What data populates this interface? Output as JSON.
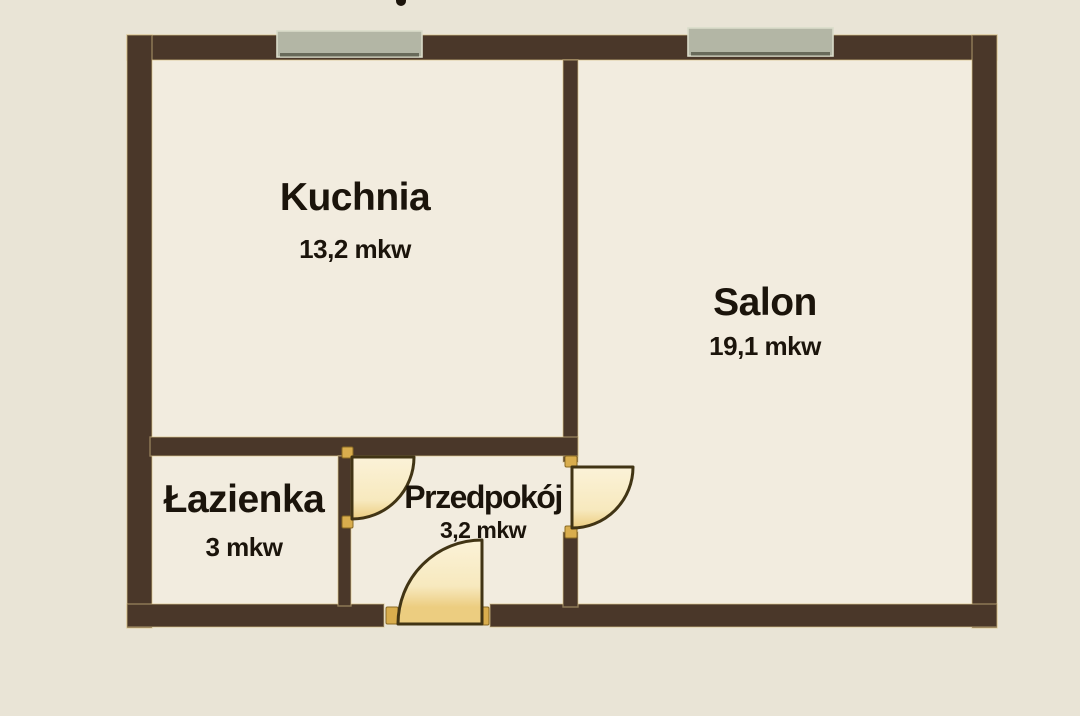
{
  "page": {
    "type": "apartment-floor-plan",
    "language": "pl"
  },
  "rooms": [
    {
      "id": "kuchnia",
      "name": "Kuchnia",
      "area": "13,2 mkw"
    },
    {
      "id": "salon",
      "name": "Salon",
      "area": "19,1 mkw"
    },
    {
      "id": "lazienka",
      "name": "Łazienka",
      "area": "3 mkw"
    },
    {
      "id": "przedpokoj",
      "name": "Przedpokój",
      "area": "3,2 mkw"
    }
  ],
  "features": {
    "windows": [
      "kuchnia-window",
      "salon-window"
    ],
    "doors": [
      "bathroom-door",
      "salon-door",
      "entrance-door"
    ]
  },
  "colors": {
    "background": "#e9e4d6",
    "room_fill": "#f2ecdf",
    "wall": "#4a3729",
    "wall_outline": "#d9c288",
    "window_fill": "#b3b6a5",
    "window_edge_light": "#dadcca",
    "window_edge_dark": "#686a5a",
    "door_fill_light": "#fbf2d8",
    "door_fill_mid": "#f7e9be",
    "door_fill_gold": "#eccd80",
    "door_outline": "#413414",
    "jamb": "#d9ad4d",
    "jamb_edge": "#8a6a22",
    "text": "#1b140b"
  }
}
